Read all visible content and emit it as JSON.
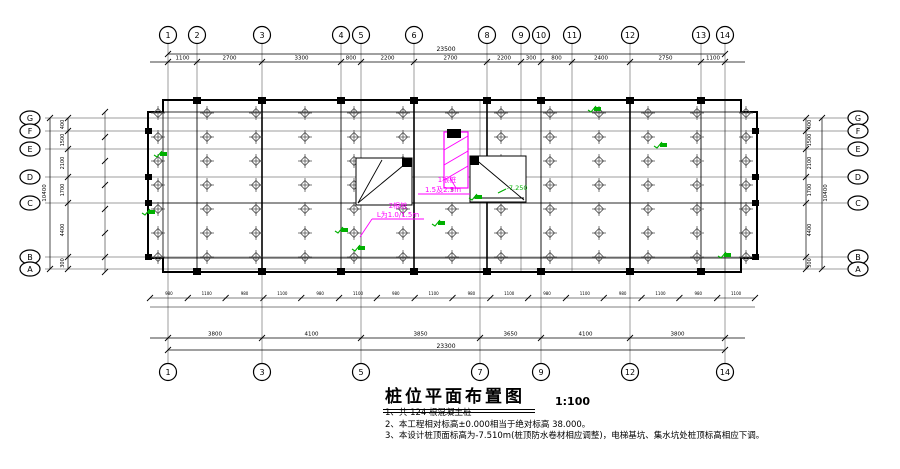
{
  "title": {
    "text": "桩位平面布置图",
    "scale": "1:100"
  },
  "notes": [
    "1、共 124 根混凝土桩",
    "2、本工程相对标高±0.000相当于绝对标高 38.000。",
    "3、本设计桩顶面标高为-7.510m(桩顶防水卷材相应调整)，电梯基坑、集水坑处桩顶标高相应下调。"
  ],
  "colors": {
    "line": "#1a1a1a",
    "pile": "#4d4d4d",
    "annotation": "#ff00ff",
    "elevation": "#00b000",
    "background": "#ffffff"
  },
  "axes": {
    "top": [
      "1",
      "2",
      "3",
      "4",
      "5",
      "6",
      "8",
      "9",
      "10",
      "11",
      "12",
      "13",
      "14"
    ],
    "bottom": [
      "1",
      "3",
      "5",
      "7",
      "9",
      "12",
      "14"
    ],
    "left": [
      "G",
      "F",
      "E",
      "D",
      "C",
      "B",
      "A"
    ],
    "right": [
      "G",
      "F",
      "E",
      "D",
      "C",
      "B",
      "A"
    ]
  },
  "dims": {
    "top": {
      "total": "23500",
      "segments": [
        "1100",
        "2700",
        "3300",
        "800",
        "2200",
        "2700",
        "2200",
        "300",
        "800",
        "2400",
        "2750",
        "1100"
      ]
    },
    "bottom": {
      "total": "23300",
      "segments": [
        "3800",
        "4100",
        "3850",
        "3650",
        "4100",
        "3800"
      ]
    },
    "left": {
      "total": "10400",
      "segments": [
        "400",
        "1500",
        "2100",
        "1700",
        "4400",
        "300"
      ]
    },
    "right": {
      "total": "10400",
      "segments": [
        "400",
        "1500",
        "2100",
        "1700",
        "4400",
        "300"
      ]
    },
    "inner_bottom": [
      "980",
      "1100",
      "980",
      "1100",
      "980",
      "1100",
      "980",
      "1100",
      "980",
      "1100",
      "980",
      "1100",
      "980",
      "1100",
      "980",
      "1100"
    ]
  },
  "annotations": {
    "pile_group_1": {
      "line1": "1根桩",
      "line2": "1.5及2.5m"
    },
    "pile_group_2": {
      "line1": "2根桩",
      "line2": "L为1.0/1.5m"
    },
    "elevation": "-7.250"
  }
}
